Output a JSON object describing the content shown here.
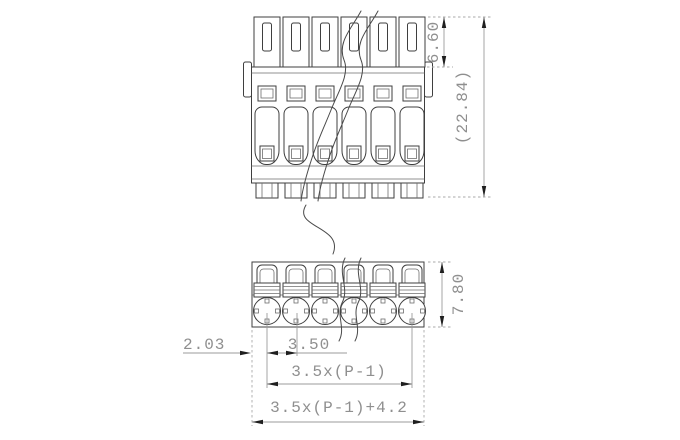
{
  "drawing": {
    "type": "technical-dimension-drawing",
    "views": {
      "front": {
        "poles_visible": 6
      },
      "plan": {
        "poles_visible": 6
      }
    },
    "dims": {
      "front_top_height": "6.60",
      "front_total_height": "(22.84)",
      "plan_depth": "7.80",
      "edge_to_first_pole": "2.03",
      "pole_pitch": "3.50",
      "poles_span": "3.5x(P-1)",
      "overall_width": "3.5x(P-1)+4.2"
    },
    "colors": {
      "background": "#ffffff",
      "outline": "#3f3f3f",
      "dimension_line": "#9b9b9b",
      "dimension_text": "#8f8f8f",
      "arrowhead": "#1f1f1f"
    }
  }
}
